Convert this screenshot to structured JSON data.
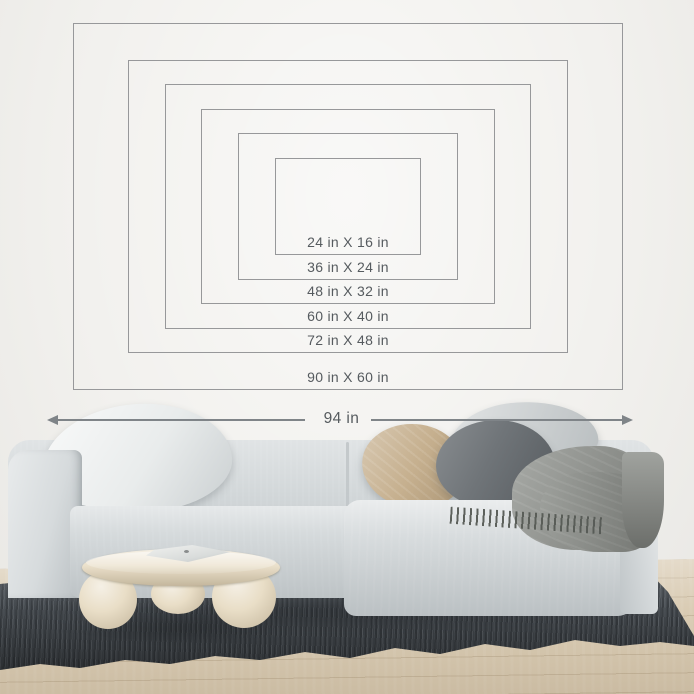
{
  "size_guide": {
    "sizes": [
      {
        "label": "24 in X 16 in",
        "width_in": 24,
        "height_in": 16
      },
      {
        "label": "36 in X 24 in",
        "width_in": 36,
        "height_in": 24
      },
      {
        "label": "48 in X 32 in",
        "width_in": 48,
        "height_in": 32
      },
      {
        "label": "60 in X 40 in",
        "width_in": 60,
        "height_in": 40
      },
      {
        "label": "72 in X 48 in",
        "width_in": 72,
        "height_in": 48
      },
      {
        "label": "90 in X 60 in",
        "width_in": 90,
        "height_in": 60
      }
    ],
    "span_label": "94 in"
  },
  "style": {
    "frame_line_color": "#97989a",
    "label_text_color": "#565b5f",
    "arrow_color": "#7f8488",
    "wall_color": "#f2f1ee",
    "floor_color": "#d9cbb3",
    "rug_color": "#41464b",
    "sofa_color": "#d2d7d9",
    "table_color": "#e9dec7",
    "throw_color": "#8e918c",
    "pillow_colors": {
      "white": "#e9ecec",
      "light_gray": "#d0d4d5",
      "beige": "#c6b08f",
      "dark_gray": "#6f7478"
    }
  }
}
